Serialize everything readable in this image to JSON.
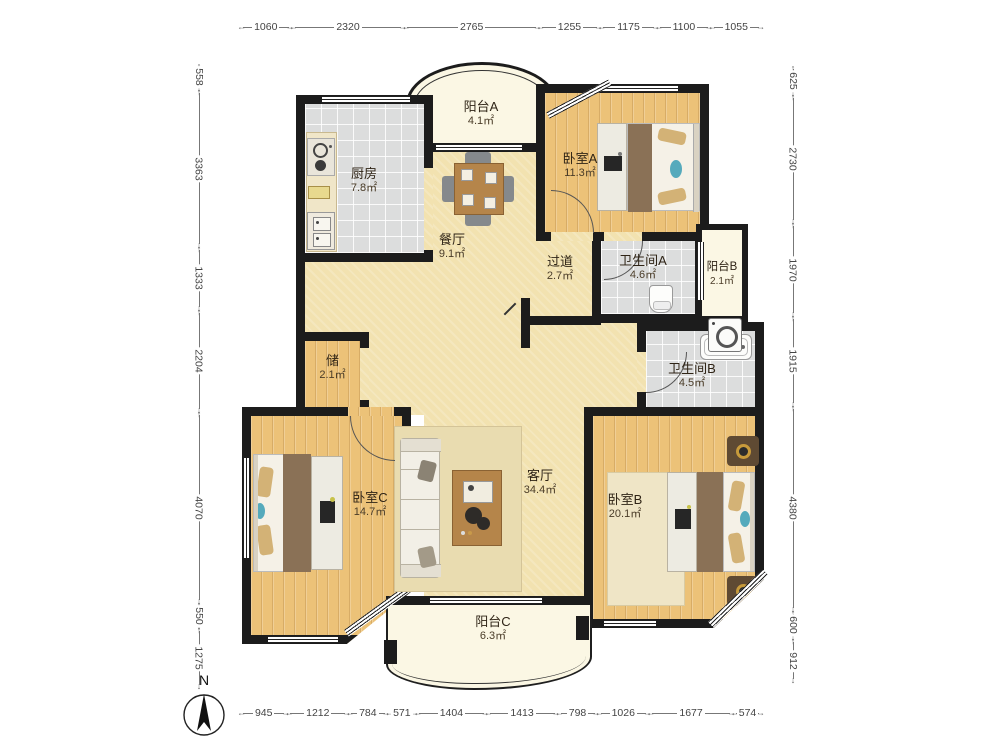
{
  "compass": {
    "label": "N"
  },
  "dimensions": {
    "top": [
      "1060",
      "2320",
      "2765",
      "1255",
      "1175",
      "1100",
      "1055"
    ],
    "bottom": [
      "945",
      "1212",
      "784",
      "571",
      "1404",
      "1413",
      "798",
      "1026",
      "1677",
      "574"
    ],
    "left": [
      "558",
      "3363",
      "1333",
      "2204",
      "4070",
      "550",
      "1275"
    ],
    "right": [
      "625",
      "2730",
      "1970",
      "1915",
      "4380",
      "600",
      "912"
    ]
  },
  "rooms": {
    "balcony_a": {
      "name": "阳台A",
      "area": "4.1㎡"
    },
    "kitchen": {
      "name": "厨房",
      "area": "7.8㎡"
    },
    "bedroom_a": {
      "name": "卧室A",
      "area": "11.3㎡"
    },
    "dining": {
      "name": "餐厅",
      "area": "9.1㎡"
    },
    "hallway": {
      "name": "过道",
      "area": "2.7㎡"
    },
    "bathroom_a": {
      "name": "卫生间A",
      "area": "4.6㎡"
    },
    "balcony_b": {
      "name": "阳台B",
      "area": "2.1㎡"
    },
    "bathroom_b": {
      "name": "卫生间B",
      "area": "4.5㎡"
    },
    "storage": {
      "name": "储",
      "area": "2.1㎡"
    },
    "living": {
      "name": "客厅",
      "area": "34.4㎡"
    },
    "bedroom_c": {
      "name": "卧室C",
      "area": "14.7㎡"
    },
    "bedroom_b": {
      "name": "卧室B",
      "area": "20.1㎡"
    },
    "balcony_c": {
      "name": "阳台C",
      "area": "6.3㎡"
    }
  },
  "colors": {
    "wall": "#1c1c1c",
    "wood_floor": "#ecc278",
    "tile_floor": "#dcdddd",
    "living_floor": "#f2e2b0",
    "balcony_floor": "#fbf7e4"
  }
}
